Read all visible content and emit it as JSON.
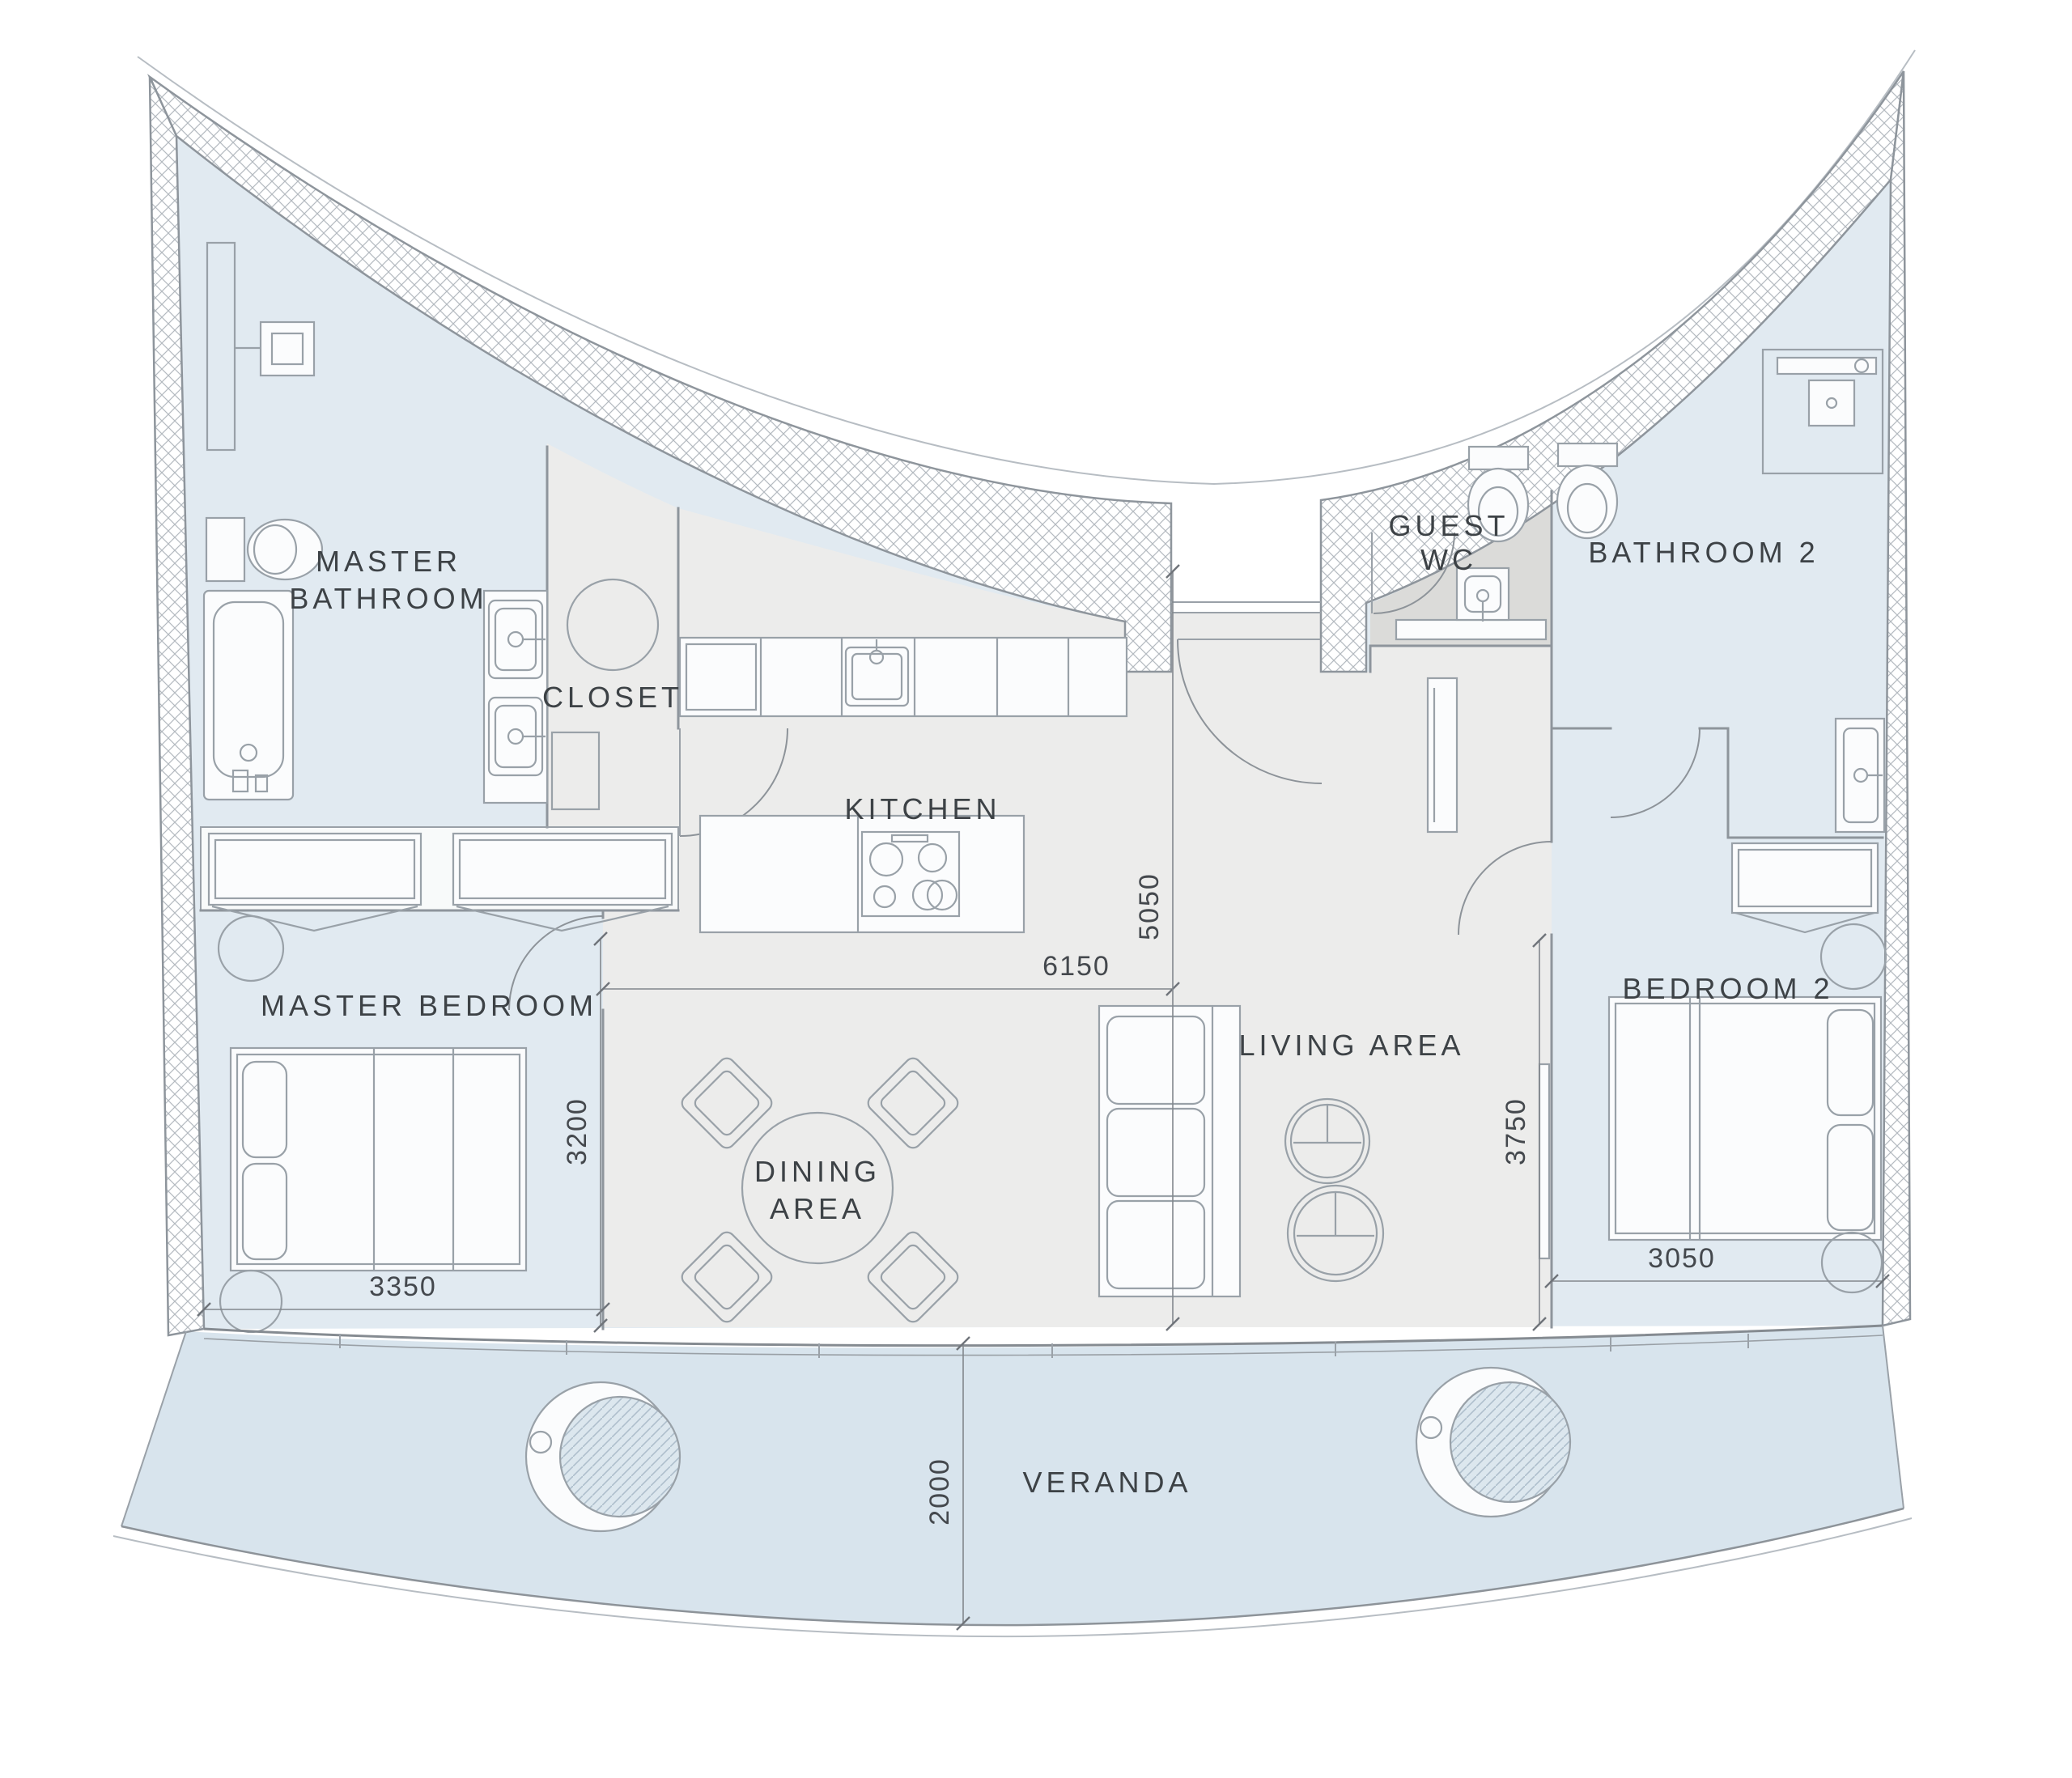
{
  "plan": {
    "type": "apartment-floor-plan",
    "rooms": {
      "master_bathroom": {
        "label": [
          "MASTER",
          "BATHROOM"
        ]
      },
      "closet": {
        "label": [
          "CLOSET"
        ]
      },
      "kitchen": {
        "label": [
          "KITCHEN"
        ]
      },
      "guest_wc": {
        "label": [
          "GUEST",
          "WC"
        ]
      },
      "bathroom_2": {
        "label": [
          "BATHROOM 2"
        ]
      },
      "master_bedroom": {
        "label": [
          "MASTER BEDROOM"
        ]
      },
      "dining_area": {
        "label": [
          "DINING",
          "AREA"
        ]
      },
      "living_area": {
        "label": [
          "LIVING AREA"
        ]
      },
      "bedroom_2": {
        "label": [
          "BEDROOM 2"
        ]
      },
      "veranda": {
        "label": [
          "VERANDA"
        ]
      }
    },
    "dimensions_mm": {
      "master_bedroom_width": "3350",
      "master_bedroom_depth": "3200",
      "living_dining_width": "6150",
      "living_dining_depth": "5050",
      "bedroom_2_depth": "3750",
      "bedroom_2_width": "3050",
      "veranda_depth": "2000"
    },
    "colors": {
      "room_blue": "#e1eaf1",
      "floor_grey": "#ececeb",
      "guest_wc_grey": "#dbdbd9",
      "wardrobe_band": "#f8fafa",
      "veranda_blue": "#d8e4ed",
      "wall_line": "#8e959c",
      "label_text": "#3d4246"
    }
  }
}
